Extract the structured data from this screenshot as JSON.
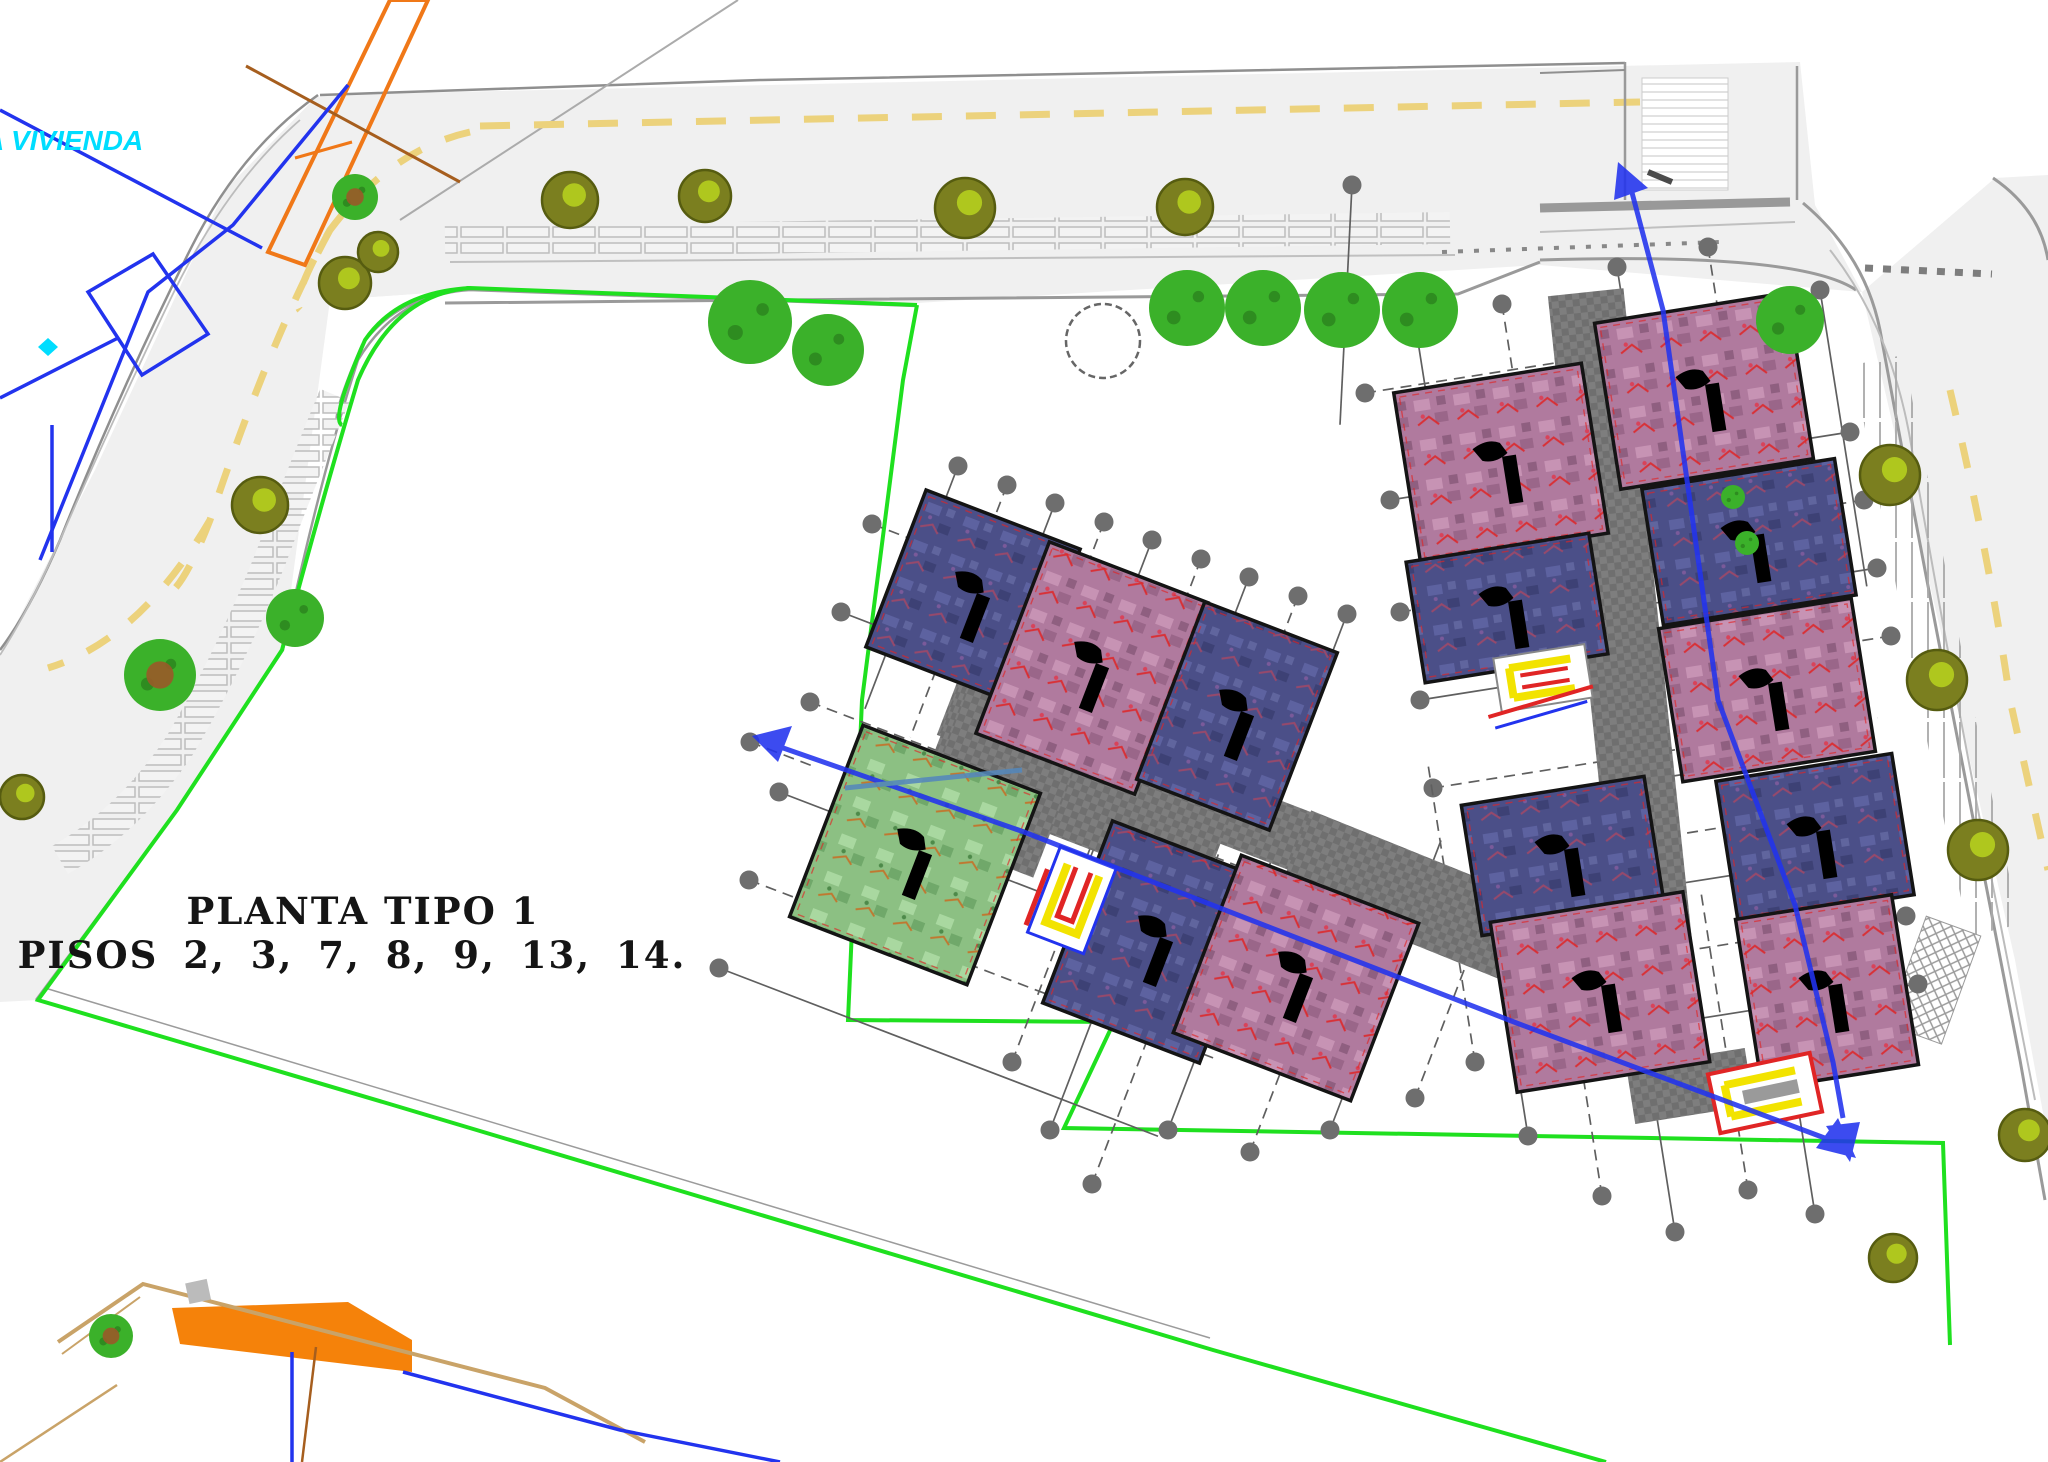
{
  "plan": {
    "title_line1": "PLANTA TIPO 1",
    "title_line2": "PISOS 2, 3, 7, 8, 9, 13, 14.",
    "floors_shown": [
      2,
      3,
      7,
      8,
      9,
      13,
      14
    ],
    "street_label": "A VIVIENDA"
  },
  "colors": {
    "boundary_green": "#1fe01f",
    "road_fill": "#f0f0f0",
    "road_edge": "#9a9a9a",
    "road_edge_dark": "#8f8f8f",
    "lane_dash": "#ecd27c",
    "tile_line": "#bdbdbd",
    "parcel_blue": "#2233ee",
    "label_cyan": "#00ddff",
    "orange_fill": "#f5820a",
    "orange_line": "#f07818",
    "tan_line": "#c9a368",
    "brown_line": "#a65e1e",
    "block_mauve": "#b07a9e",
    "block_blue": "#4b4f88",
    "block_green": "#8cc083",
    "corridor_gray": "#6f6f6f",
    "corridor_dot": "#8a8a8a",
    "tree_olive": "#7b7f1f",
    "tree_olive_hi": "#b9d41e",
    "tree_green": "#3bb12a",
    "tree_green_dark": "#2e8c20",
    "grid_gray": "#5f5f5f",
    "core_red": "#e02525",
    "core_yellow": "#f2e300",
    "stair_black": "#000000"
  }
}
